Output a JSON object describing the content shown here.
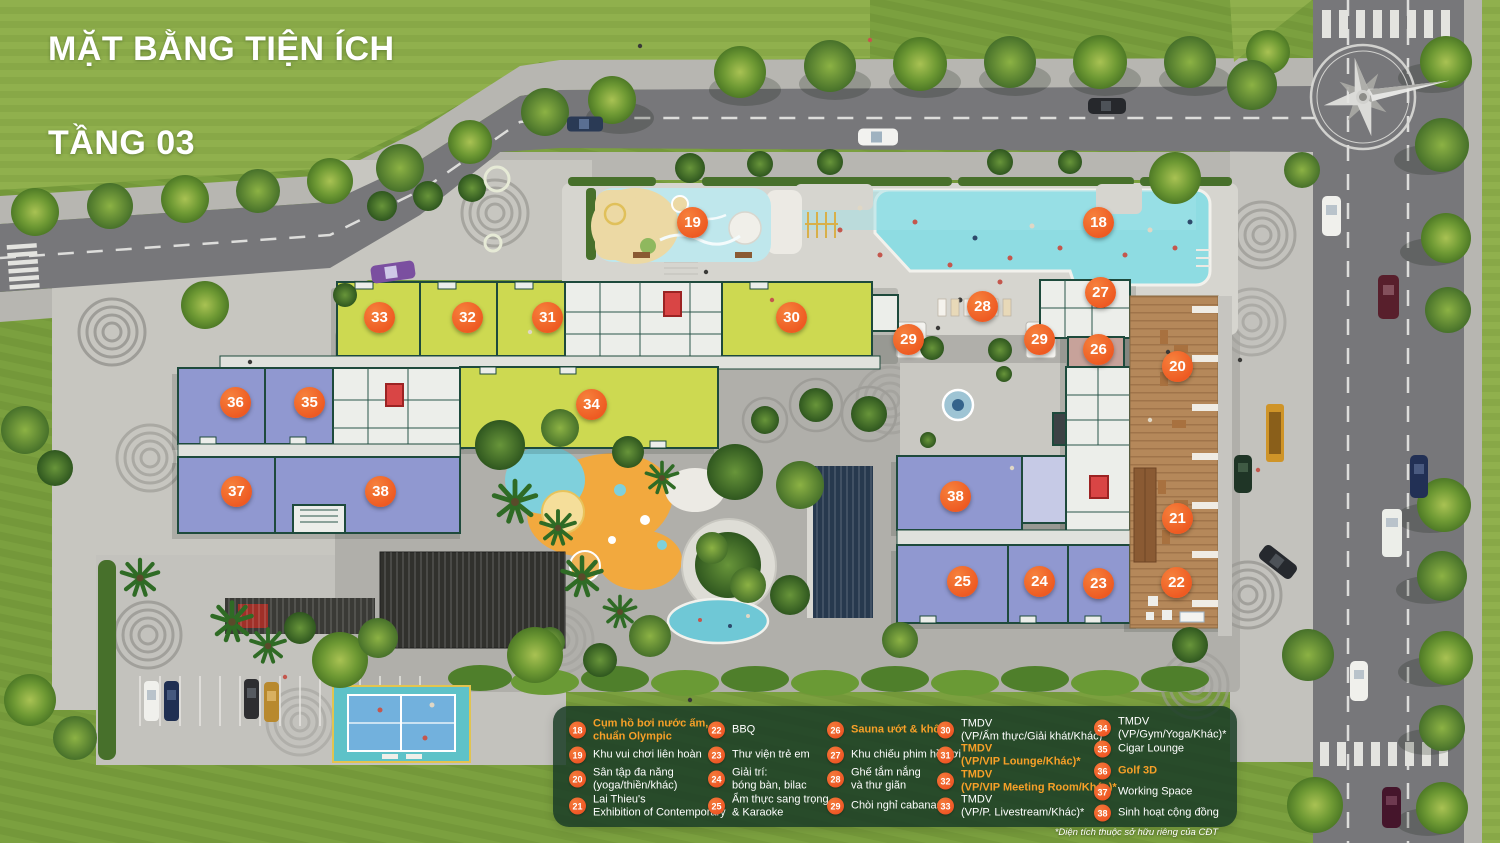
{
  "title": {
    "line1": "MẶT BẰNG TIỆN ÍCH",
    "line2": "TẦNG 03"
  },
  "colors": {
    "marker_orange": "#ee5a22",
    "legend_highlight_orange": "#f7a028",
    "legend_panel_green": "rgba(27,61,38,0.86)",
    "room_lime": "#cdd951",
    "room_purple": "#9098d0",
    "pool_teal": "#8edce2",
    "wood_deck": "#b5885a",
    "grass_green": "#76993c"
  },
  "plan_markers": [
    {
      "label": "19",
      "x": 693,
      "y": 223
    },
    {
      "label": "18",
      "x": 1099,
      "y": 223
    },
    {
      "label": "27",
      "x": 1101,
      "y": 293
    },
    {
      "label": "28",
      "x": 983,
      "y": 307
    },
    {
      "label": "29",
      "x": 909,
      "y": 340
    },
    {
      "label": "29",
      "x": 1040,
      "y": 340
    },
    {
      "label": "26",
      "x": 1099,
      "y": 350
    },
    {
      "label": "20",
      "x": 1178,
      "y": 367
    },
    {
      "label": "33",
      "x": 380,
      "y": 318
    },
    {
      "label": "32",
      "x": 468,
      "y": 318
    },
    {
      "label": "31",
      "x": 548,
      "y": 318
    },
    {
      "label": "30",
      "x": 792,
      "y": 318
    },
    {
      "label": "36",
      "x": 236,
      "y": 403
    },
    {
      "label": "35",
      "x": 310,
      "y": 403
    },
    {
      "label": "34",
      "x": 592,
      "y": 405
    },
    {
      "label": "37",
      "x": 237,
      "y": 492
    },
    {
      "label": "38",
      "x": 381,
      "y": 492
    },
    {
      "label": "38",
      "x": 956,
      "y": 497
    },
    {
      "label": "21",
      "x": 1178,
      "y": 519
    },
    {
      "label": "25",
      "x": 963,
      "y": 582
    },
    {
      "label": "24",
      "x": 1040,
      "y": 582
    },
    {
      "label": "23",
      "x": 1099,
      "y": 584
    },
    {
      "label": "22",
      "x": 1177,
      "y": 583
    }
  ],
  "legend": {
    "items": [
      {
        "num": "18",
        "x": 578,
        "y": 730,
        "highlight": true,
        "lines": [
          "Cụm hồ bơi nước ấm,",
          "chuẩn Olympic"
        ]
      },
      {
        "num": "19",
        "x": 578,
        "y": 755,
        "highlight": false,
        "lines": [
          "Khu vui chơi liên hoàn"
        ]
      },
      {
        "num": "20",
        "x": 578,
        "y": 779,
        "highlight": false,
        "lines": [
          "Sân tập đa năng",
          "(yoga/thiền/khác)"
        ]
      },
      {
        "num": "21",
        "x": 578,
        "y": 806,
        "highlight": false,
        "lines": [
          "Lai Thieu's",
          "Exhibition of Contemporary"
        ]
      },
      {
        "num": "22",
        "x": 717,
        "y": 730,
        "highlight": false,
        "lines": [
          "BBQ"
        ]
      },
      {
        "num": "23",
        "x": 717,
        "y": 755,
        "highlight": false,
        "lines": [
          "Thư viện trẻ em"
        ]
      },
      {
        "num": "24",
        "x": 717,
        "y": 779,
        "highlight": false,
        "lines": [
          "Giải trí:",
          "bóng bàn, bilac"
        ]
      },
      {
        "num": "25",
        "x": 717,
        "y": 806,
        "highlight": false,
        "lines": [
          "Ẩm thực sang trọng",
          "& Karaoke"
        ]
      },
      {
        "num": "26",
        "x": 836,
        "y": 730,
        "highlight": true,
        "lines": [
          "Sauna ướt & khô"
        ]
      },
      {
        "num": "27",
        "x": 836,
        "y": 755,
        "highlight": false,
        "lines": [
          "Khu chiếu phim hồ bơi"
        ]
      },
      {
        "num": "28",
        "x": 836,
        "y": 779,
        "highlight": false,
        "lines": [
          "Ghế tắm nắng",
          "và thư giãn"
        ]
      },
      {
        "num": "29",
        "x": 836,
        "y": 806,
        "highlight": false,
        "lines": [
          "Chòi nghỉ cabanas"
        ]
      },
      {
        "num": "30",
        "x": 946,
        "y": 730,
        "highlight": false,
        "lines": [
          "TMDV",
          "(VP/Ẩm thực/Giải khát/Khác)*"
        ]
      },
      {
        "num": "31",
        "x": 946,
        "y": 755,
        "highlight": true,
        "lines": [
          "TMDV",
          "(VP/VIP Lounge/Khác)*"
        ]
      },
      {
        "num": "32",
        "x": 946,
        "y": 781,
        "highlight": true,
        "lines": [
          "TMDV",
          "(VP/VIP Meeting Room/Khác)*"
        ]
      },
      {
        "num": "33",
        "x": 946,
        "y": 806,
        "highlight": false,
        "lines": [
          "TMDV",
          "(VP/P. Livestream/Khác)*"
        ]
      },
      {
        "num": "34",
        "x": 1103,
        "y": 728,
        "highlight": false,
        "lines": [
          "TMDV",
          "(VP/Gym/Yoga/Khác)*"
        ]
      },
      {
        "num": "35",
        "x": 1103,
        "y": 749,
        "highlight": false,
        "lines": [
          "Cigar Lounge"
        ]
      },
      {
        "num": "36",
        "x": 1103,
        "y": 771,
        "highlight": true,
        "lines": [
          "Golf 3D"
        ]
      },
      {
        "num": "37",
        "x": 1103,
        "y": 792,
        "highlight": false,
        "lines": [
          "Working Space"
        ]
      },
      {
        "num": "38",
        "x": 1103,
        "y": 813,
        "highlight": false,
        "lines": [
          "Sinh hoạt cộng đồng"
        ]
      }
    ],
    "footnote": "*Diện tích thuộc sở hữu riêng của CĐT"
  }
}
